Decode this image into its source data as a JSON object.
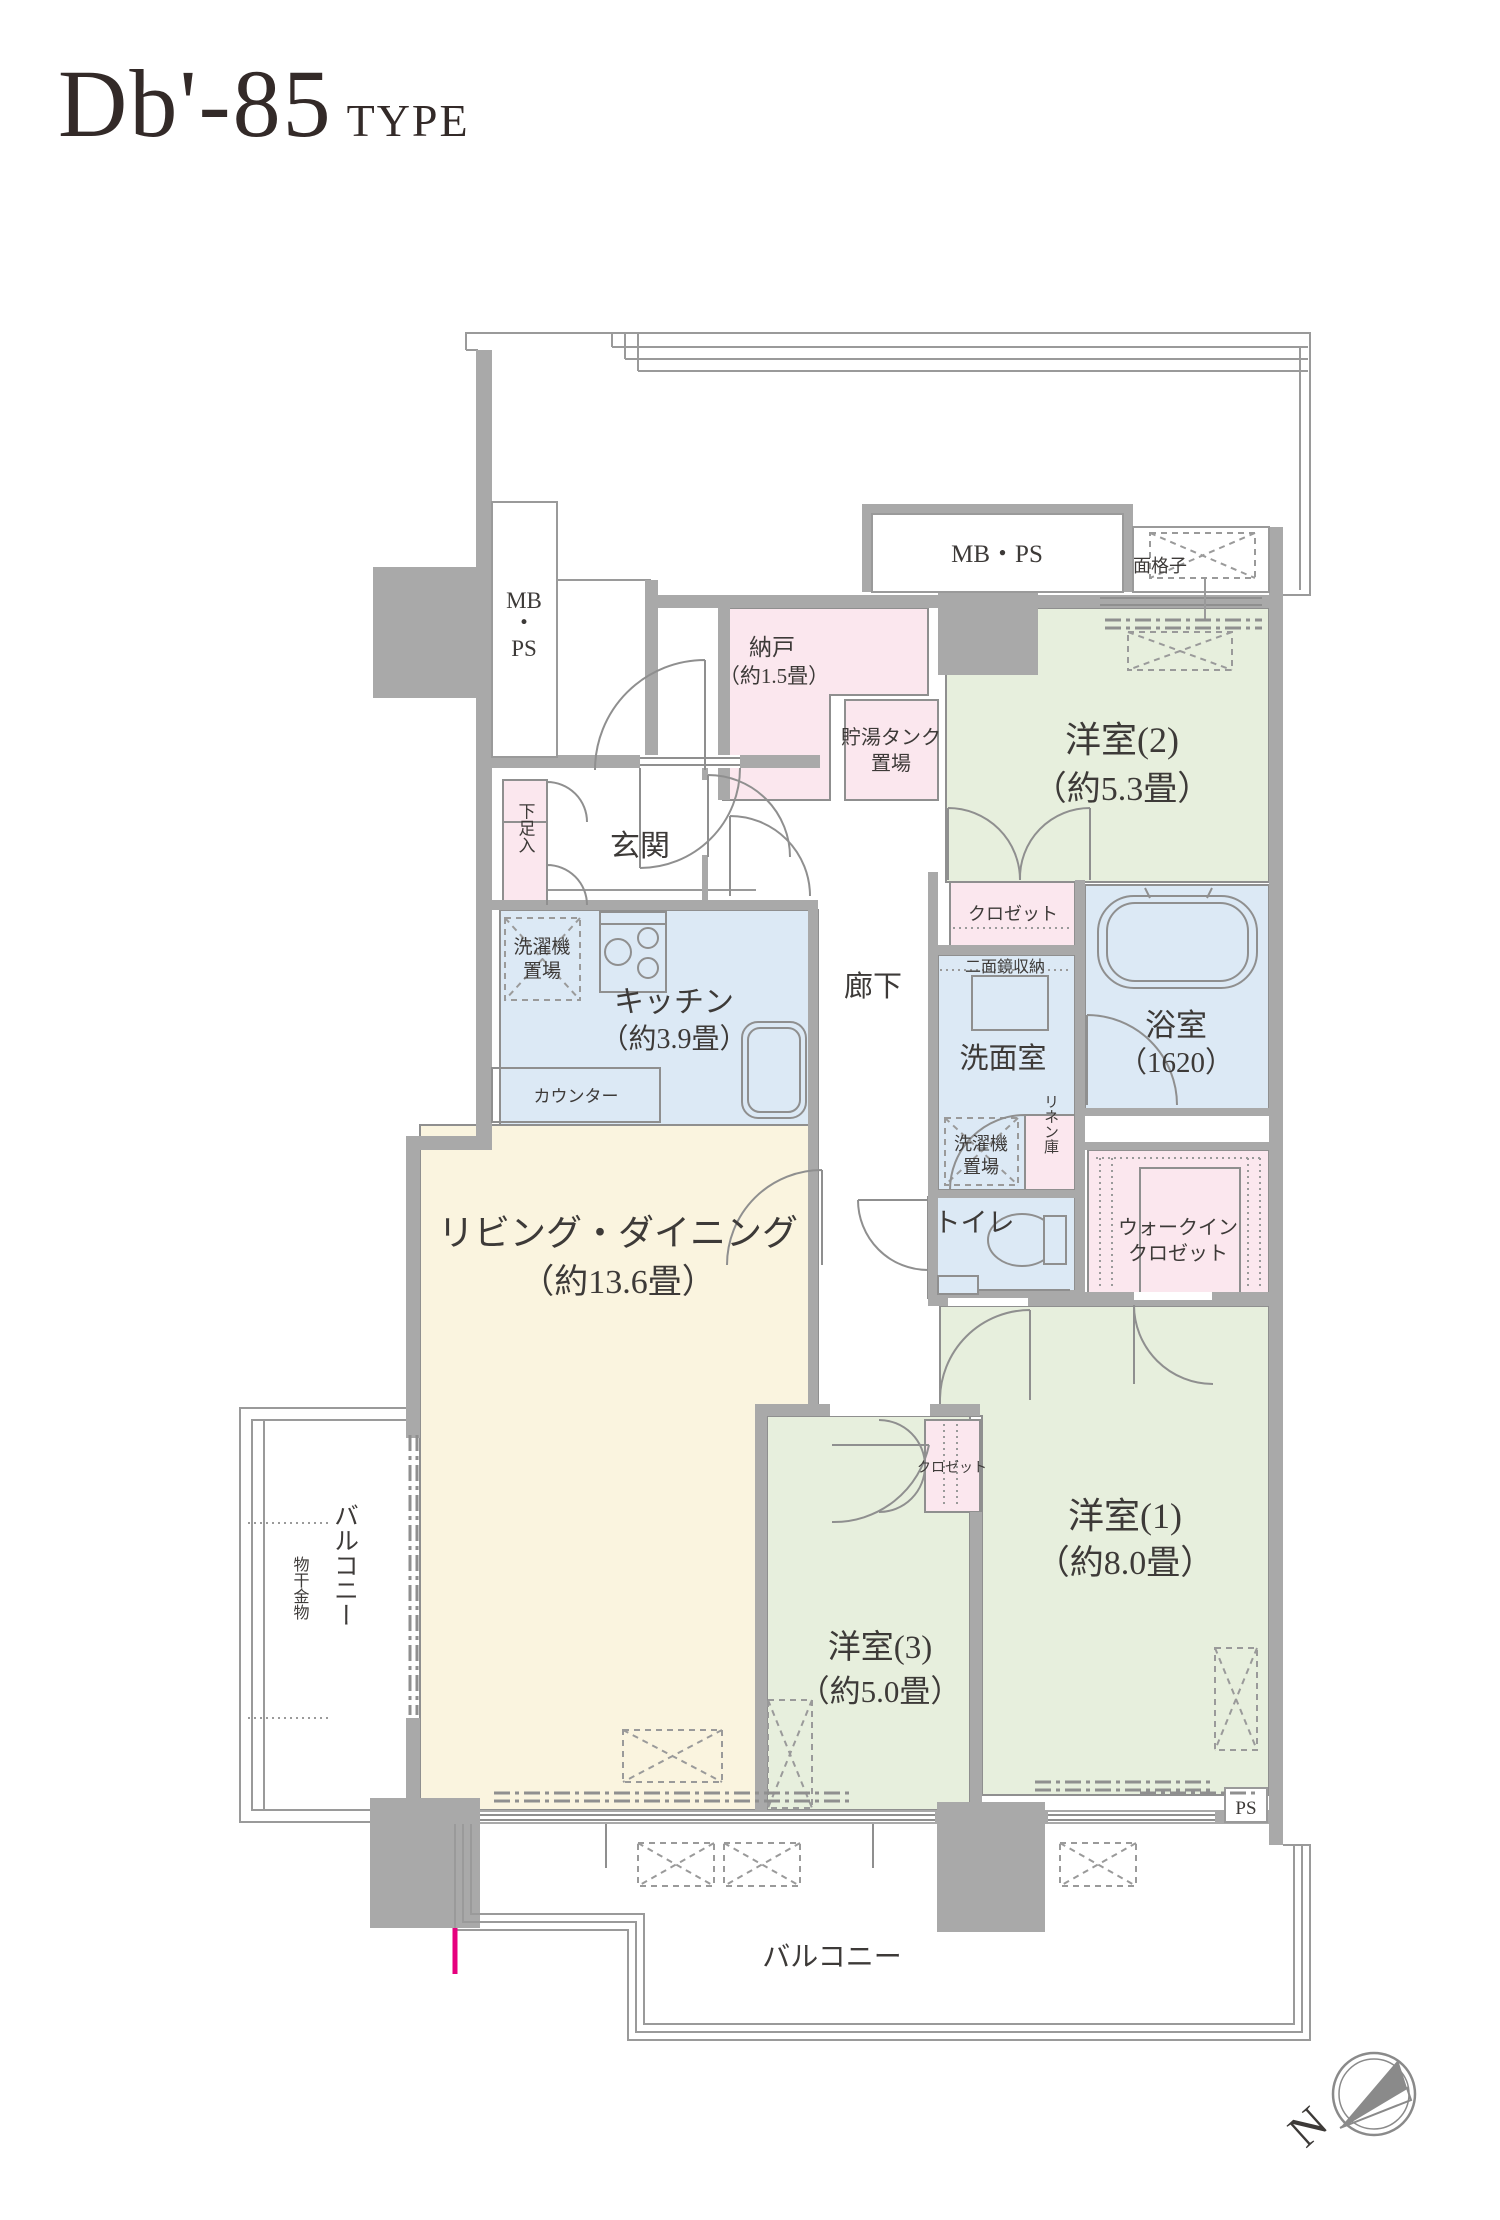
{
  "title": {
    "code": "Db'-85",
    "suffix": "TYPE"
  },
  "colors": {
    "wall_gray": "#a9a9a9",
    "line_gray": "#8f8f8f",
    "room_green": "#e7efdd",
    "room_pink": "#fbe7ee",
    "room_blue": "#dce9f5",
    "room_cream": "#faf4df",
    "accent_pink": "#e6007e",
    "title_color": "#332a28"
  },
  "plan": {
    "rooms": {
      "living": {
        "name": "リビング・ダイニング",
        "size": "（約13.6畳）"
      },
      "kitchen": {
        "name": "キッチン",
        "size": "（約3.9畳）"
      },
      "western1": {
        "name": "洋室(1)",
        "size": "（約8.0畳）"
      },
      "western2": {
        "name": "洋室(2)",
        "size": "（約5.3畳）"
      },
      "western3": {
        "name": "洋室(3)",
        "size": "（約5.0畳）"
      },
      "nando": {
        "name": "納戸",
        "size": "（約1.5畳）"
      },
      "tank": {
        "line1": "貯湯タンク",
        "line2": "置場"
      },
      "bath": {
        "name": "浴室",
        "size": "（1620）"
      },
      "washroom": {
        "name": "洗面室"
      },
      "toilet": {
        "name": "トイレ"
      },
      "entrance": {
        "name": "玄関"
      },
      "hallway": {
        "name": "廊下"
      },
      "wic": {
        "line1": "ウォークイン",
        "line2": "クロゼット"
      }
    },
    "labels": {
      "closet2": "クロゼット",
      "closet3": "クロゼット",
      "mirror": "二面鏡収納",
      "washer1_line1": "洗濯機",
      "washer1_line2": "置場",
      "washer2_line1": "洗濯機",
      "washer2_line2": "置場",
      "linen": "リネン庫",
      "counter": "カウンター",
      "shoe_box": "下足入",
      "mbps_top": "MB・PS",
      "mbps_left_1": "MB",
      "mbps_left_2": "・",
      "mbps_left_3": "PS",
      "grille": "面格子",
      "ps": "PS"
    },
    "balcony": {
      "bottom": "バルコニー",
      "left": "バルコニー",
      "drying": "物干金物"
    },
    "compass": {
      "north": "N"
    }
  }
}
